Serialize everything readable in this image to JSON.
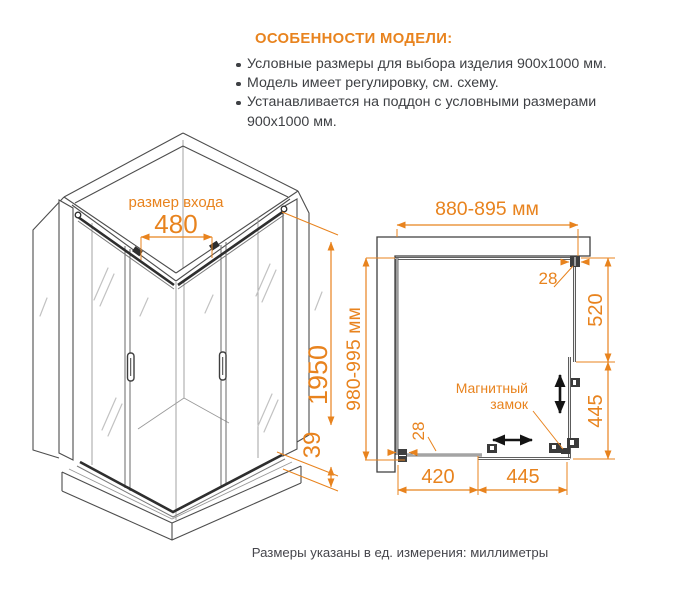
{
  "features": {
    "heading": "ОСОБЕННОСТИ МОДЕЛИ:",
    "items": [
      "Условные размеры для выбора изделия 900x1000 мм.",
      "Модель имеет регулировку, см. схему.",
      "Устанавливается на поддон с условными размерами 900x1000 мм."
    ]
  },
  "iso_view": {
    "entrance_label": "размер входа",
    "entrance_width": "480",
    "height": "1950",
    "tray_height": "39"
  },
  "plan_view": {
    "width_range": "880-895 мм",
    "depth_range": "980-995 мм",
    "top_profile": "28",
    "bottom_profile": "28",
    "right_fixed": "520",
    "right_door": "445",
    "bottom_fixed": "420",
    "bottom_door": "445",
    "magnet_line1": "Магнитный",
    "magnet_line2": "замок"
  },
  "footer": "Размеры указаны в ед. измерения: миллиметры",
  "colors": {
    "accent": "#E8831E",
    "line": "#4D4D4D",
    "text": "#3E4044"
  }
}
